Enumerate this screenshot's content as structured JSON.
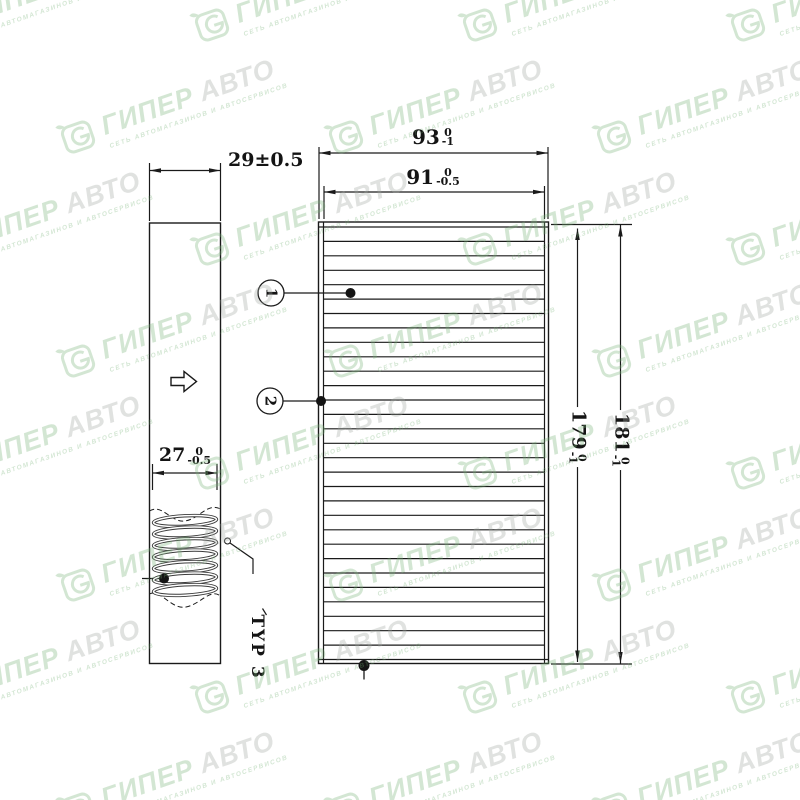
{
  "watermark": {
    "logo": "giperavto-swirl-logo",
    "brand_primary": "ГИПЕР",
    "brand_secondary": "АВТО",
    "tagline": "СЕТЬ АВТОМАГАЗИНОВ И АВТОСЕРВИСОВ",
    "color_primary": "#79b479",
    "color_secondary": "#a2a8a2"
  },
  "drawing": {
    "side_view": {
      "depth_dim": "29±0.5",
      "pleat_pack_dim": {
        "value": "27",
        "tol_upper": "0",
        "tol_lower": "-0.5"
      },
      "type_label": "TYP 3",
      "flow_arrow": "hollow-right-arrow"
    },
    "front_view": {
      "outer_width_dim": {
        "value": "93",
        "tol_upper": "0",
        "tol_lower": "-1"
      },
      "inner_width_dim": {
        "value": "91",
        "tol_upper": "0",
        "tol_lower": "-0.5"
      },
      "pleat_height_dim": {
        "value": "179",
        "tol_upper": "0",
        "tol_lower": "-1"
      },
      "overall_height_dim": {
        "value": "181",
        "tol_upper": "0",
        "tol_lower": "-1"
      },
      "pleat_count": 29
    },
    "callouts": [
      {
        "label": "1"
      },
      {
        "label": "2"
      }
    ]
  }
}
